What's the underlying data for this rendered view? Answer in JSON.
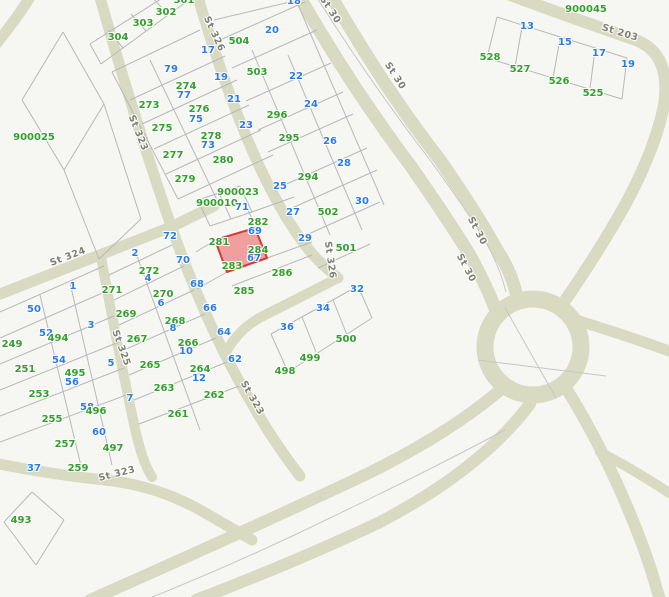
{
  "map": {
    "width": 669,
    "height": 597,
    "colors": {
      "background": "#f6f6f3",
      "road": "#d8dac1",
      "parcel_line": "#b6b8bb",
      "centerline": "#c6c8c2",
      "green_label": "#33a02c",
      "blue_label": "#2b7de3",
      "street_label": "#7d7e74",
      "highlight_fill": "#f09e9e",
      "highlight_stroke": "#d03c3c"
    },
    "highlight_parcel": {
      "points": "215,240 255,228 267,258 227,272",
      "stroke_width": 2
    },
    "roundabout": {
      "cx": 533,
      "cy": 347,
      "r": 48,
      "w": 17
    },
    "roads": [
      {
        "d": "M 32 -6 Q 16 20 -4 44",
        "w": 11
      },
      {
        "d": "M 99 -6 Q 130 105 171 226 Q 208 330 250 400 Q 270 437 300 476",
        "w": 11
      },
      {
        "d": "M 101 257 Q 117 345 134 424 Q 142 462 152 477",
        "w": 10
      },
      {
        "d": "M -5 296 L 171 227 L 214 206",
        "w": 11
      },
      {
        "d": "M 197 -6 Q 228 100 262 172 Q 290 230 316 258 Q 328 270 338 278",
        "w": 11
      },
      {
        "d": "M 338 278 Q 295 300 265 315 Q 240 327 226 352",
        "w": 10
      },
      {
        "d": "M 502 -8 Q 575 19 633 39 Q 672 52 664 105 Q 655 150 625 205 Q 600 250 562 305",
        "w": 12
      },
      {
        "d": "M 298 -6 Q 350 85 410 165 Q 445 215 468 252 Q 484 280 495 308",
        "w": 13
      },
      {
        "d": "M 330 -6 Q 382 85 440 160 Q 478 215 497 250 Q 511 271 516 293",
        "w": 13
      },
      {
        "d": "M 576 320 Q 625 335 672 352",
        "w": 11
      },
      {
        "d": "M 566 388 Q 612 462 645 552 Q 652 572 660 600",
        "w": 12
      },
      {
        "d": "M 600 452 Q 638 472 674 496",
        "w": 10
      },
      {
        "d": "M 498 392 Q 440 440 350 482 Q 230 538 90 600",
        "w": 12
      },
      {
        "d": "M 530 404 Q 480 470 380 522 Q 300 560 196 600",
        "w": 12
      },
      {
        "d": "M -6 463 Q 55 475 105 480 Q 155 485 200 510 Q 228 526 252 540",
        "w": 11
      }
    ],
    "centerlines": [
      {
        "d": "M 316 -4 Q 370 82 430 160 Q 468 212 487 244 Q 500 268 506 292"
      },
      {
        "d": "M 505 430 Q 430 470 330 518 Q 240 562 145 600"
      },
      {
        "d": "M 505 308 L 556 398"
      },
      {
        "d": "M 478 360 L 606 376"
      }
    ],
    "parcel_lines": [
      [
        90,
        44,
        175,
        -10
      ],
      [
        101,
        64,
        186,
        2
      ],
      [
        108,
        30,
        123,
        48
      ],
      [
        131,
        14,
        146,
        31
      ],
      [
        153,
        -2,
        168,
        15
      ],
      [
        90,
        44,
        101,
        64
      ],
      [
        112,
        72,
        200,
        30
      ],
      [
        130,
        100,
        225,
        56
      ],
      [
        142,
        124,
        237,
        80
      ],
      [
        154,
        149,
        249,
        105
      ],
      [
        166,
        174,
        261,
        130
      ],
      [
        178,
        199,
        273,
        155
      ],
      [
        150,
        60,
        217,
        200
      ],
      [
        112,
        72,
        178,
        199
      ],
      [
        214,
        20,
        298,
        0
      ],
      [
        220,
        40,
        305,
        2
      ],
      [
        232,
        68,
        317,
        30
      ],
      [
        246,
        101,
        331,
        63
      ],
      [
        258,
        130,
        343,
        92
      ],
      [
        268,
        152,
        353,
        114
      ],
      [
        282,
        186,
        367,
        148
      ],
      [
        292,
        208,
        377,
        170
      ],
      [
        304,
        236,
        380,
        202
      ],
      [
        318,
        268,
        370,
        244
      ],
      [
        252,
        50,
        330,
        235
      ],
      [
        288,
        55,
        362,
        230
      ],
      [
        296,
        0,
        384,
        205
      ],
      [
        198,
        200,
        240,
        186
      ],
      [
        240,
        186,
        252,
        212
      ],
      [
        252,
        212,
        210,
        226
      ],
      [
        210,
        226,
        198,
        200
      ],
      [
        219,
        193,
        231,
        219
      ],
      [
        252,
        212,
        294,
        197
      ],
      [
        246,
        206,
        257,
        229
      ],
      [
        267,
        258,
        312,
        242
      ],
      [
        232,
        286,
        312,
        255
      ],
      [
        196,
        252,
        215,
        240
      ],
      [
        197,
        289,
        227,
        272
      ],
      [
        109,
        275,
        172,
        245
      ],
      [
        114,
        300,
        184,
        266
      ],
      [
        119,
        325,
        194,
        290
      ],
      [
        124,
        350,
        205,
        314
      ],
      [
        129,
        375,
        216,
        338
      ],
      [
        134,
        400,
        227,
        362
      ],
      [
        139,
        424,
        239,
        386
      ],
      [
        137,
        256,
        200,
        430
      ],
      [
        0,
        312,
        104,
        266
      ],
      [
        0,
        338,
        109,
        290
      ],
      [
        0,
        364,
        114,
        316
      ],
      [
        0,
        390,
        119,
        342
      ],
      [
        0,
        416,
        124,
        368
      ],
      [
        0,
        442,
        129,
        394
      ],
      [
        40,
        295,
        82,
        470
      ],
      [
        70,
        283,
        112,
        465
      ],
      [
        271,
        334,
        358,
        286
      ],
      [
        358,
        286,
        372,
        318
      ],
      [
        372,
        318,
        288,
        372
      ],
      [
        288,
        372,
        271,
        334
      ],
      [
        302,
        317,
        316,
        352
      ],
      [
        333,
        300,
        347,
        335
      ],
      [
        32,
        492,
        64,
        520
      ],
      [
        64,
        520,
        36,
        565
      ],
      [
        36,
        565,
        4,
        522
      ],
      [
        4,
        522,
        32,
        492
      ],
      [
        497,
        17,
        627,
        58
      ],
      [
        627,
        58,
        622,
        99
      ],
      [
        622,
        99,
        487,
        58
      ],
      [
        487,
        58,
        497,
        17
      ],
      [
        522,
        27,
        515,
        67
      ],
      [
        560,
        39,
        553,
        78
      ],
      [
        595,
        50,
        590,
        88
      ],
      [
        63,
        32,
        104,
        104
      ],
      [
        104,
        104,
        64,
        170
      ],
      [
        64,
        170,
        22,
        100
      ],
      [
        22,
        100,
        63,
        32
      ],
      [
        104,
        104,
        141,
        219
      ],
      [
        141,
        219,
        99,
        259
      ],
      [
        64,
        170,
        99,
        259
      ]
    ],
    "street_labels": [
      {
        "t": "St 326",
        "x": 214,
        "y": 34,
        "r": 65
      },
      {
        "t": "St 30",
        "x": 330,
        "y": 10,
        "r": 57
      },
      {
        "t": "St 30",
        "x": 395,
        "y": 76,
        "r": 57
      },
      {
        "t": "St 203",
        "x": 620,
        "y": 33,
        "r": 17
      },
      {
        "t": "St 323",
        "x": 138,
        "y": 133,
        "r": 68
      },
      {
        "t": "St 324",
        "x": 68,
        "y": 257,
        "r": -21
      },
      {
        "t": "St 325",
        "x": 121,
        "y": 348,
        "r": 70
      },
      {
        "t": "St 326",
        "x": 330,
        "y": 260,
        "r": 82
      },
      {
        "t": "St 30",
        "x": 477,
        "y": 231,
        "r": 62
      },
      {
        "t": "St 30",
        "x": 466,
        "y": 268,
        "r": 62
      },
      {
        "t": "St 323",
        "x": 252,
        "y": 398,
        "r": 60
      },
      {
        "t": "St 323",
        "x": 117,
        "y": 474,
        "r": -14
      }
    ],
    "parcel_labels": [
      {
        "t": "301",
        "x": 184,
        "y": 1,
        "c": "g"
      },
      {
        "t": "302",
        "x": 166,
        "y": 13,
        "c": "g"
      },
      {
        "t": "303",
        "x": 143,
        "y": 24,
        "c": "g"
      },
      {
        "t": "304",
        "x": 118,
        "y": 38,
        "c": "g"
      },
      {
        "t": "900025",
        "x": 34,
        "y": 138,
        "c": "g"
      },
      {
        "t": "18",
        "x": 294,
        "y": 2,
        "c": "b"
      },
      {
        "t": "20",
        "x": 272,
        "y": 31,
        "c": "b"
      },
      {
        "t": "504",
        "x": 239,
        "y": 42,
        "c": "g"
      },
      {
        "t": "503",
        "x": 257,
        "y": 73,
        "c": "g"
      },
      {
        "t": "22",
        "x": 296,
        "y": 77,
        "c": "b"
      },
      {
        "t": "17",
        "x": 208,
        "y": 51,
        "c": "b"
      },
      {
        "t": "79",
        "x": 171,
        "y": 70,
        "c": "b"
      },
      {
        "t": "19",
        "x": 221,
        "y": 78,
        "c": "b"
      },
      {
        "t": "274",
        "x": 186,
        "y": 87,
        "c": "g"
      },
      {
        "t": "77",
        "x": 184,
        "y": 96,
        "c": "b"
      },
      {
        "t": "273",
        "x": 149,
        "y": 106,
        "c": "g"
      },
      {
        "t": "21",
        "x": 234,
        "y": 100,
        "c": "b"
      },
      {
        "t": "276",
        "x": 199,
        "y": 110,
        "c": "g"
      },
      {
        "t": "75",
        "x": 196,
        "y": 120,
        "c": "b"
      },
      {
        "t": "275",
        "x": 162,
        "y": 129,
        "c": "g"
      },
      {
        "t": "23",
        "x": 246,
        "y": 126,
        "c": "b"
      },
      {
        "t": "278",
        "x": 211,
        "y": 137,
        "c": "g"
      },
      {
        "t": "73",
        "x": 208,
        "y": 146,
        "c": "b"
      },
      {
        "t": "277",
        "x": 173,
        "y": 156,
        "c": "g"
      },
      {
        "t": "280",
        "x": 223,
        "y": 161,
        "c": "g"
      },
      {
        "t": "279",
        "x": 185,
        "y": 180,
        "c": "g"
      },
      {
        "t": "296",
        "x": 277,
        "y": 116,
        "c": "g"
      },
      {
        "t": "24",
        "x": 311,
        "y": 105,
        "c": "b"
      },
      {
        "t": "295",
        "x": 289,
        "y": 139,
        "c": "g"
      },
      {
        "t": "26",
        "x": 330,
        "y": 142,
        "c": "b"
      },
      {
        "t": "294",
        "x": 308,
        "y": 178,
        "c": "g"
      },
      {
        "t": "28",
        "x": 344,
        "y": 164,
        "c": "b"
      },
      {
        "t": "30",
        "x": 362,
        "y": 202,
        "c": "b"
      },
      {
        "t": "502",
        "x": 328,
        "y": 213,
        "c": "g"
      },
      {
        "t": "501",
        "x": 346,
        "y": 249,
        "c": "g"
      },
      {
        "t": "25",
        "x": 280,
        "y": 187,
        "c": "b"
      },
      {
        "t": "27",
        "x": 293,
        "y": 213,
        "c": "b"
      },
      {
        "t": "29",
        "x": 305,
        "y": 239,
        "c": "b"
      },
      {
        "t": "900023",
        "x": 238,
        "y": 193,
        "c": "g"
      },
      {
        "t": "900010",
        "x": 217,
        "y": 204,
        "c": "g"
      },
      {
        "t": "71",
        "x": 242,
        "y": 208,
        "c": "b"
      },
      {
        "t": "282",
        "x": 258,
        "y": 223,
        "c": "g"
      },
      {
        "t": "69",
        "x": 255,
        "y": 232,
        "c": "b"
      },
      {
        "t": "281",
        "x": 219,
        "y": 243,
        "c": "g"
      },
      {
        "t": "284",
        "x": 258,
        "y": 251,
        "c": "g"
      },
      {
        "t": "67",
        "x": 254,
        "y": 259,
        "c": "b"
      },
      {
        "t": "283",
        "x": 232,
        "y": 267,
        "c": "g"
      },
      {
        "t": "286",
        "x": 282,
        "y": 274,
        "c": "g"
      },
      {
        "t": "285",
        "x": 244,
        "y": 292,
        "c": "g"
      },
      {
        "t": "72",
        "x": 170,
        "y": 237,
        "c": "b"
      },
      {
        "t": "70",
        "x": 183,
        "y": 261,
        "c": "b"
      },
      {
        "t": "68",
        "x": 197,
        "y": 285,
        "c": "b"
      },
      {
        "t": "66",
        "x": 210,
        "y": 309,
        "c": "b"
      },
      {
        "t": "64",
        "x": 224,
        "y": 333,
        "c": "b"
      },
      {
        "t": "62",
        "x": 235,
        "y": 360,
        "c": "b"
      },
      {
        "t": "2",
        "x": 135,
        "y": 254,
        "c": "b"
      },
      {
        "t": "272",
        "x": 149,
        "y": 272,
        "c": "g"
      },
      {
        "t": "4",
        "x": 148,
        "y": 279,
        "c": "b"
      },
      {
        "t": "271",
        "x": 112,
        "y": 291,
        "c": "g"
      },
      {
        "t": "270",
        "x": 163,
        "y": 295,
        "c": "g"
      },
      {
        "t": "6",
        "x": 161,
        "y": 304,
        "c": "b"
      },
      {
        "t": "269",
        "x": 126,
        "y": 315,
        "c": "g"
      },
      {
        "t": "268",
        "x": 175,
        "y": 322,
        "c": "g"
      },
      {
        "t": "8",
        "x": 173,
        "y": 329,
        "c": "b"
      },
      {
        "t": "267",
        "x": 137,
        "y": 340,
        "c": "g"
      },
      {
        "t": "266",
        "x": 188,
        "y": 344,
        "c": "g"
      },
      {
        "t": "10",
        "x": 186,
        "y": 352,
        "c": "b"
      },
      {
        "t": "265",
        "x": 150,
        "y": 366,
        "c": "g"
      },
      {
        "t": "264",
        "x": 200,
        "y": 370,
        "c": "g"
      },
      {
        "t": "12",
        "x": 199,
        "y": 379,
        "c": "b"
      },
      {
        "t": "263",
        "x": 164,
        "y": 389,
        "c": "g"
      },
      {
        "t": "262",
        "x": 214,
        "y": 396,
        "c": "g"
      },
      {
        "t": "261",
        "x": 178,
        "y": 415,
        "c": "g"
      },
      {
        "t": "1",
        "x": 73,
        "y": 287,
        "c": "b"
      },
      {
        "t": "3",
        "x": 91,
        "y": 326,
        "c": "b"
      },
      {
        "t": "5",
        "x": 111,
        "y": 364,
        "c": "b"
      },
      {
        "t": "7",
        "x": 130,
        "y": 399,
        "c": "b"
      },
      {
        "t": "50",
        "x": 34,
        "y": 310,
        "c": "b"
      },
      {
        "t": "52",
        "x": 46,
        "y": 334,
        "c": "b"
      },
      {
        "t": "54",
        "x": 59,
        "y": 361,
        "c": "b"
      },
      {
        "t": "56",
        "x": 72,
        "y": 383,
        "c": "b"
      },
      {
        "t": "58",
        "x": 87,
        "y": 408,
        "c": "b"
      },
      {
        "t": "60",
        "x": 99,
        "y": 433,
        "c": "b"
      },
      {
        "t": "249",
        "x": 12,
        "y": 345,
        "c": "g"
      },
      {
        "t": "251",
        "x": 25,
        "y": 370,
        "c": "g"
      },
      {
        "t": "253",
        "x": 39,
        "y": 395,
        "c": "g"
      },
      {
        "t": "255",
        "x": 52,
        "y": 420,
        "c": "g"
      },
      {
        "t": "257",
        "x": 65,
        "y": 445,
        "c": "g"
      },
      {
        "t": "259",
        "x": 78,
        "y": 469,
        "c": "g"
      },
      {
        "t": "494",
        "x": 58,
        "y": 339,
        "c": "g"
      },
      {
        "t": "495",
        "x": 75,
        "y": 374,
        "c": "g"
      },
      {
        "t": "496",
        "x": 96,
        "y": 412,
        "c": "g"
      },
      {
        "t": "497",
        "x": 113,
        "y": 449,
        "c": "g"
      },
      {
        "t": "37",
        "x": 34,
        "y": 469,
        "c": "b"
      },
      {
        "t": "493",
        "x": 21,
        "y": 521,
        "c": "g"
      },
      {
        "t": "36",
        "x": 287,
        "y": 328,
        "c": "b"
      },
      {
        "t": "34",
        "x": 323,
        "y": 309,
        "c": "b"
      },
      {
        "t": "32",
        "x": 357,
        "y": 290,
        "c": "b"
      },
      {
        "t": "500",
        "x": 346,
        "y": 340,
        "c": "g"
      },
      {
        "t": "499",
        "x": 310,
        "y": 359,
        "c": "g"
      },
      {
        "t": "498",
        "x": 285,
        "y": 372,
        "c": "g"
      },
      {
        "t": "900045",
        "x": 586,
        "y": 10,
        "c": "g"
      },
      {
        "t": "13",
        "x": 527,
        "y": 27,
        "c": "b"
      },
      {
        "t": "15",
        "x": 565,
        "y": 43,
        "c": "b"
      },
      {
        "t": "17",
        "x": 599,
        "y": 54,
        "c": "b"
      },
      {
        "t": "19",
        "x": 628,
        "y": 65,
        "c": "b"
      },
      {
        "t": "528",
        "x": 490,
        "y": 58,
        "c": "g"
      },
      {
        "t": "527",
        "x": 520,
        "y": 70,
        "c": "g"
      },
      {
        "t": "526",
        "x": 559,
        "y": 82,
        "c": "g"
      },
      {
        "t": "525",
        "x": 593,
        "y": 94,
        "c": "g"
      }
    ]
  }
}
